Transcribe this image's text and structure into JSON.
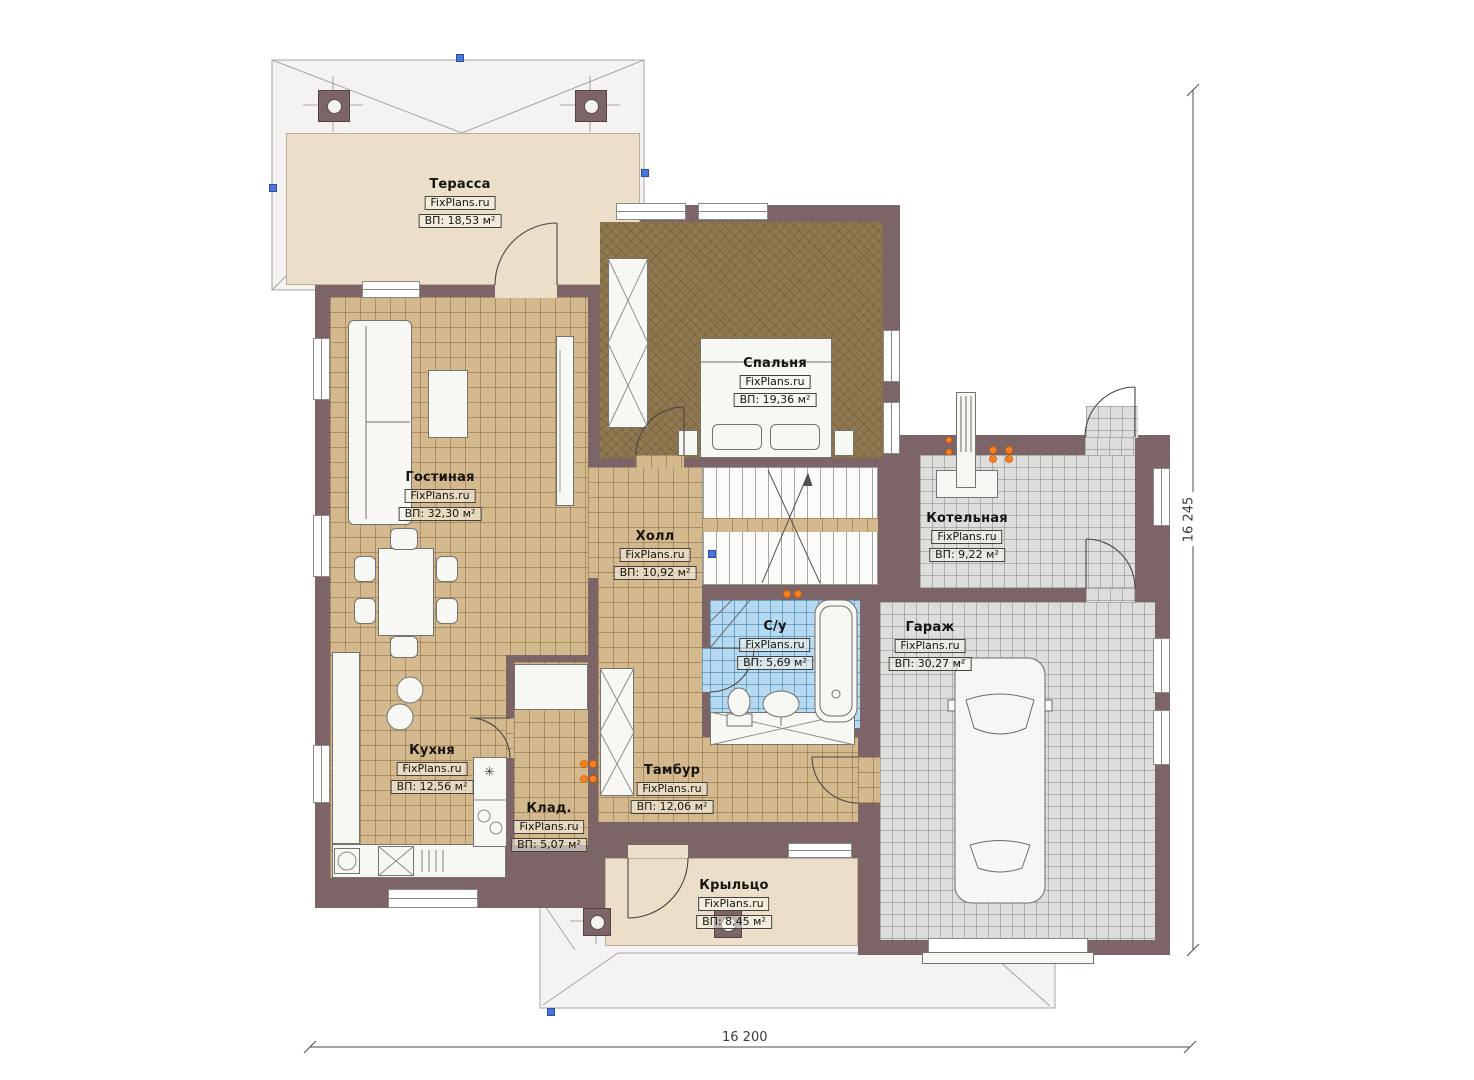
{
  "plan": {
    "brand": "FixPlans.ru",
    "rooms": [
      {
        "id": "terrace",
        "name": "Терасса",
        "area": "ВП: 18,53 м²"
      },
      {
        "id": "bedroom",
        "name": "Спальня",
        "area": "ВП: 19,36 м²"
      },
      {
        "id": "living",
        "name": "Гостиная",
        "area": "ВП: 32,30 м²"
      },
      {
        "id": "hall",
        "name": "Холл",
        "area": "ВП: 10,92 м²"
      },
      {
        "id": "boiler",
        "name": "Котельная",
        "area": "ВП: 9,22 м²"
      },
      {
        "id": "bathroom",
        "name": "С/у",
        "area": "ВП: 5,69 м²"
      },
      {
        "id": "garage",
        "name": "Гараж",
        "area": "ВП: 30,27 м²"
      },
      {
        "id": "kitchen",
        "name": "Кухня",
        "area": "ВП: 12,56 м²"
      },
      {
        "id": "storage",
        "name": "Клад.",
        "area": "ВП: 5,07 м²"
      },
      {
        "id": "vestibule",
        "name": "Тамбур",
        "area": "ВП: 12,06 м²"
      },
      {
        "id": "porch",
        "name": "Крыльцо",
        "area": "ВП: 8,45 м²"
      }
    ],
    "dimensions": {
      "width_label": "16 200",
      "height_label": "16 245"
    },
    "icons": {
      "stove_burner": "✳"
    },
    "colors": {
      "wall": "#7d6466",
      "floor_tan": "#d4b98f",
      "floor_beige": "#ecdfc9",
      "carpet_brown": "#8f7850",
      "tile_gray": "#dddddb",
      "tile_blue": "#b5daf1",
      "accent_orange": "#ff7f1f",
      "handle_blue": "#4a74d8"
    }
  }
}
